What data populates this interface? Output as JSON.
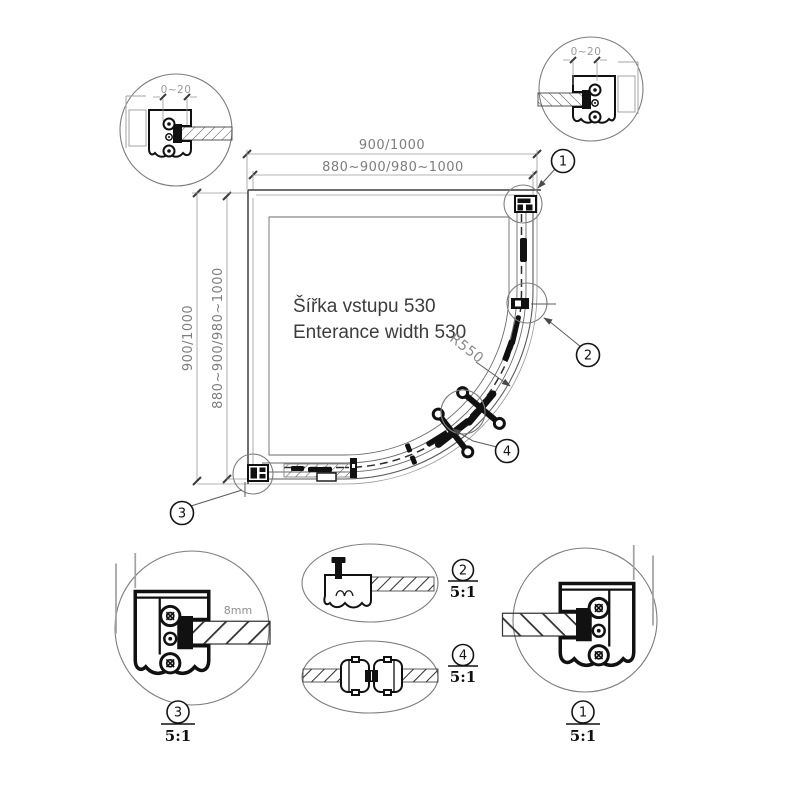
{
  "plan": {
    "dim_top_outer": "900/1000",
    "dim_top_inner": "880~900/980~1000",
    "dim_left_outer": "900/1000",
    "dim_left_inner": "880~900/980~1000",
    "entrance_label_cz": "Šířka vstupu 530",
    "entrance_label_en": "Enterance width 530",
    "radius_label": "R550",
    "balloons": {
      "b1": "1",
      "b2": "2",
      "b3": "3",
      "b4": "4"
    }
  },
  "details": {
    "top_left": {
      "adjust_range": "0~20"
    },
    "top_right": {
      "adjust_range": "0~20"
    },
    "bottom_left": {
      "balloon": "3",
      "scale": "5:1",
      "glass_thickness": "8mm"
    },
    "bottom_right": {
      "balloon": "1",
      "scale": "5:1"
    },
    "middle_top": {
      "balloon": "2",
      "scale": "5:1"
    },
    "middle_bottom": {
      "balloon": "4",
      "scale": "5:1"
    }
  },
  "colors": {
    "line": "#4a4a4a",
    "dim_text": "#7d7d7d",
    "hardware": "#111111",
    "background": "#ffffff"
  }
}
